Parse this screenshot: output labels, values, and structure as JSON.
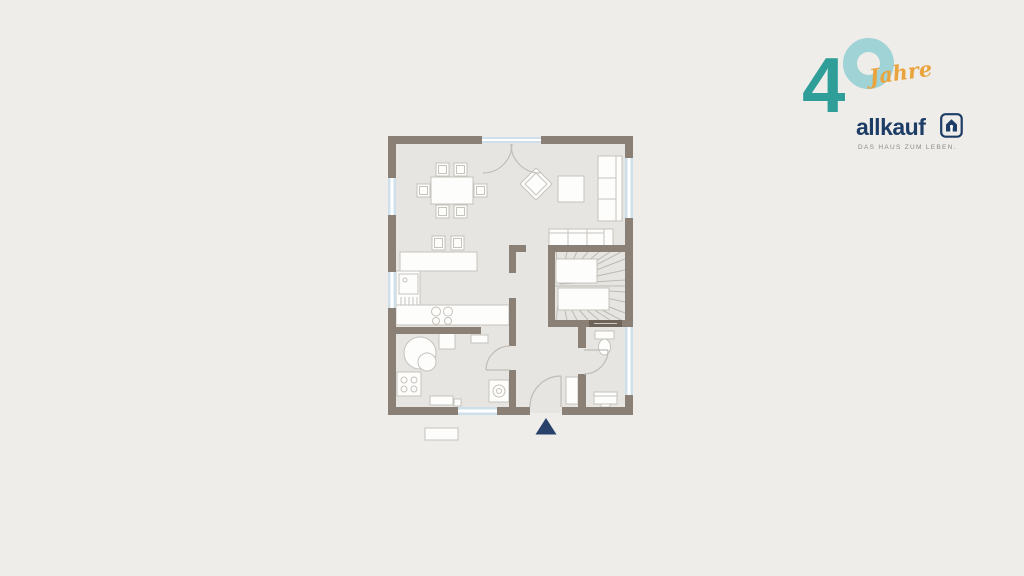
{
  "background_color": "#efedea",
  "logo": {
    "number": "4",
    "ring_digit": "0",
    "jahre_label": "Jahre",
    "brand_name": "allkauf",
    "tagline": "DAS HAUS ZUM LEBEN.",
    "colors": {
      "number": "#2f9e99",
      "ring": "#9fd3d6",
      "jahre": "#e9a43e",
      "brand": "#1d3c66",
      "tagline": "#8a8a8a",
      "house_icon": "#1d3c66"
    }
  },
  "floorplan": {
    "colors": {
      "wall": "#8a8076",
      "floor": "#e7e5e2",
      "furniture_fill": "#fdfdfc",
      "furniture_stroke": "#c6c2bc",
      "window_glass": "#cfe0ea",
      "door_arc": "#c0bdb7",
      "stair_line": "#bdbab4",
      "entrance_marker": "#27416b",
      "shaft_label_strip": "#6e6459"
    },
    "icons": {
      "entrance_marker": "triangle-up",
      "staircase": "winder-stairs",
      "boiler": "double-circle",
      "washing_machine": "square-with-drum-circle",
      "cooktop": "four-burner-circles",
      "toilet": "tank-and-bowl",
      "dining_set": "table-with-six-chairs",
      "sofas": "sectioned-rectangles"
    }
  }
}
